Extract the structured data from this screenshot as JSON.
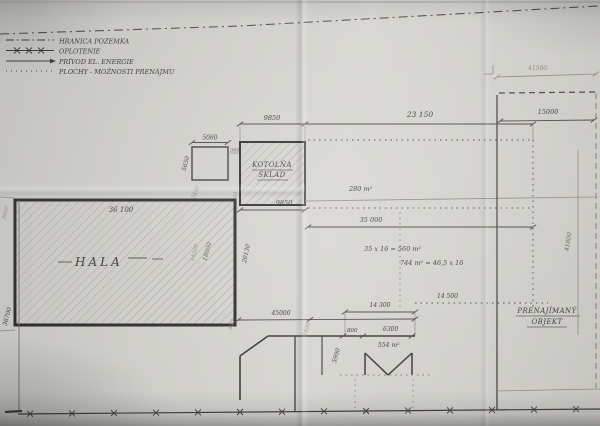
{
  "drawing": {
    "legend": {
      "items": [
        {
          "symbol": "dash-dot-line",
          "label": "HRANICA POZEMKA"
        },
        {
          "symbol": "fence-x-line",
          "label": "OPLOTENIE"
        },
        {
          "symbol": "arrow-line",
          "label": "PRÍVOD EL. ENERGIE"
        },
        {
          "symbol": "dotted-line",
          "label": "PLOCHY - MOŽNOSTI PRENÁJMU"
        }
      ]
    },
    "labels": {
      "hala": "HALA",
      "kotolna_line1": "KOTOLŇA",
      "kotolna_line2": "SKLAD",
      "prenajimany_line1": "PRENAJÍMANÝ",
      "prenajimany_line2": "OBJEKT"
    },
    "areas": {
      "a280": "280 m²",
      "a560": "35 x 16 = 560 m²",
      "a744": "744 m² = 46,5 x 16",
      "a554": "554 m²"
    },
    "dims": {
      "sq5060": "5060",
      "sq5650": "5650",
      "sq3400": "3400",
      "d360": "360",
      "d240": "240",
      "kot9850_top": "9850",
      "kot9850_bottom": "9850",
      "span23150": "23 150",
      "hala36100": "36 100",
      "hala14500": "14500",
      "hala18000": "18000",
      "hala20130": "20130",
      "left3600": "3600",
      "left36700": "36700",
      "mid35000": "35 000",
      "d14300": "14 300",
      "d14500": "14 500",
      "d45000": "45000",
      "d850": "850",
      "d2400": "2400",
      "d800": "800",
      "d6300": "6300",
      "d5900": "5900",
      "right41500": "41500",
      "right15000": "15000",
      "right41800": "41800"
    }
  }
}
